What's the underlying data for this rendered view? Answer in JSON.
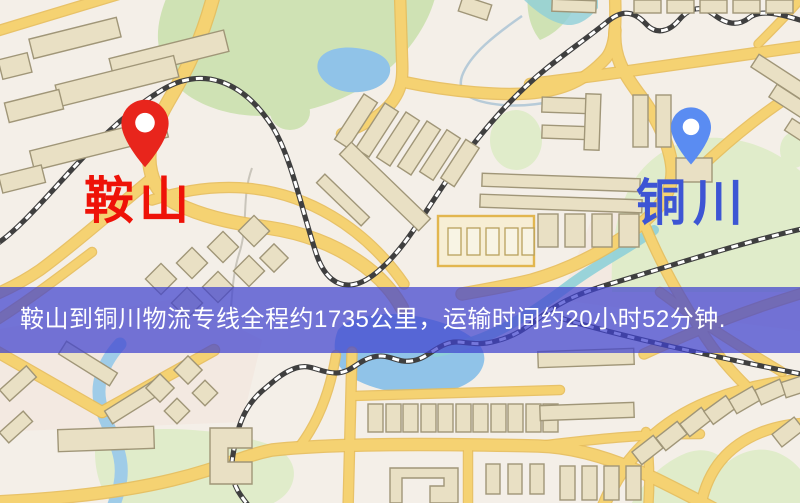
{
  "map": {
    "markers": [
      {
        "id": "origin",
        "label": "鞍山",
        "pin": "red-pin-icon"
      },
      {
        "id": "destination",
        "label": "铜川",
        "pin": "blue-pin-icon"
      }
    ],
    "colors": {
      "bg": "#f4efe8",
      "road": "#f5d272",
      "roadCasing": "#e7bd5a",
      "bldg": "#e9e0c4",
      "bldgStroke": "#a09678",
      "green": "#cfe2b4",
      "greenLight": "#e0ecca",
      "water": "#90c3e8",
      "canal": "#8fd0d8",
      "rail": "#3f3f3f",
      "bannerBg": "rgba(64,66,206,0.72)",
      "bannerText": "#ffffff",
      "pinRed": "#e8251c",
      "labelRed": "#ee1208",
      "pinBlue": "#5a8cf2",
      "labelBlue": "#3d55d4"
    }
  },
  "banner": {
    "text": "鞍山到铜川物流专线全程约1735公里，运输时间约20小时52分钟.",
    "origin": "鞍山",
    "destination": "铜川",
    "distance": "1735公里",
    "duration": "20小时52分钟"
  }
}
